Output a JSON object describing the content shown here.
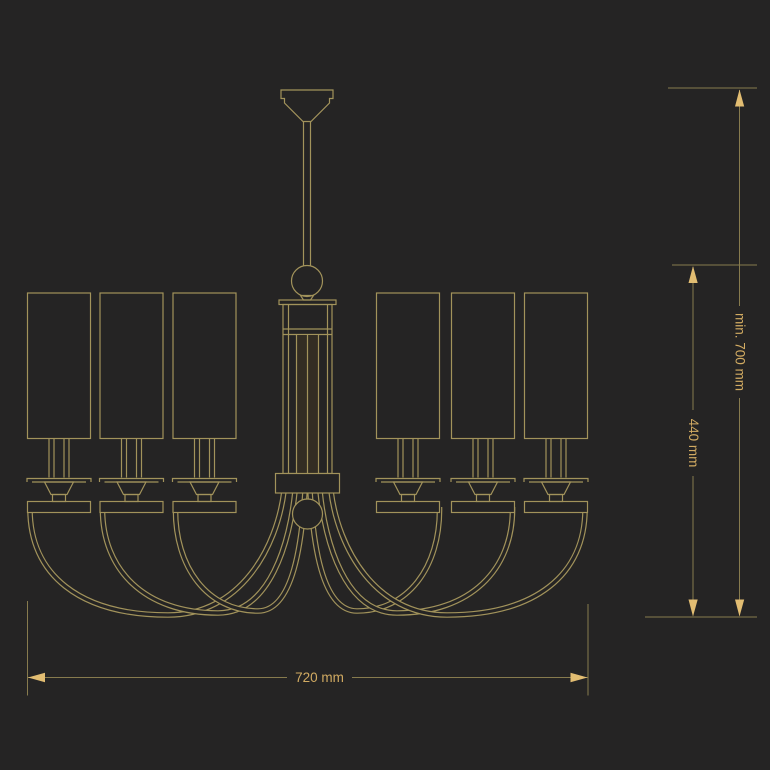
{
  "colors": {
    "bg": "#252424",
    "line": "#a2935b",
    "dimline": "#877b4e",
    "accent": "#e2bd72",
    "text": "#d2ab62"
  },
  "dimensions": {
    "width": "720 mm",
    "overall_height": "min. 700 mm",
    "body_height": "440 mm"
  },
  "fixture": {
    "shade_count": 6,
    "arm_count": 6
  }
}
